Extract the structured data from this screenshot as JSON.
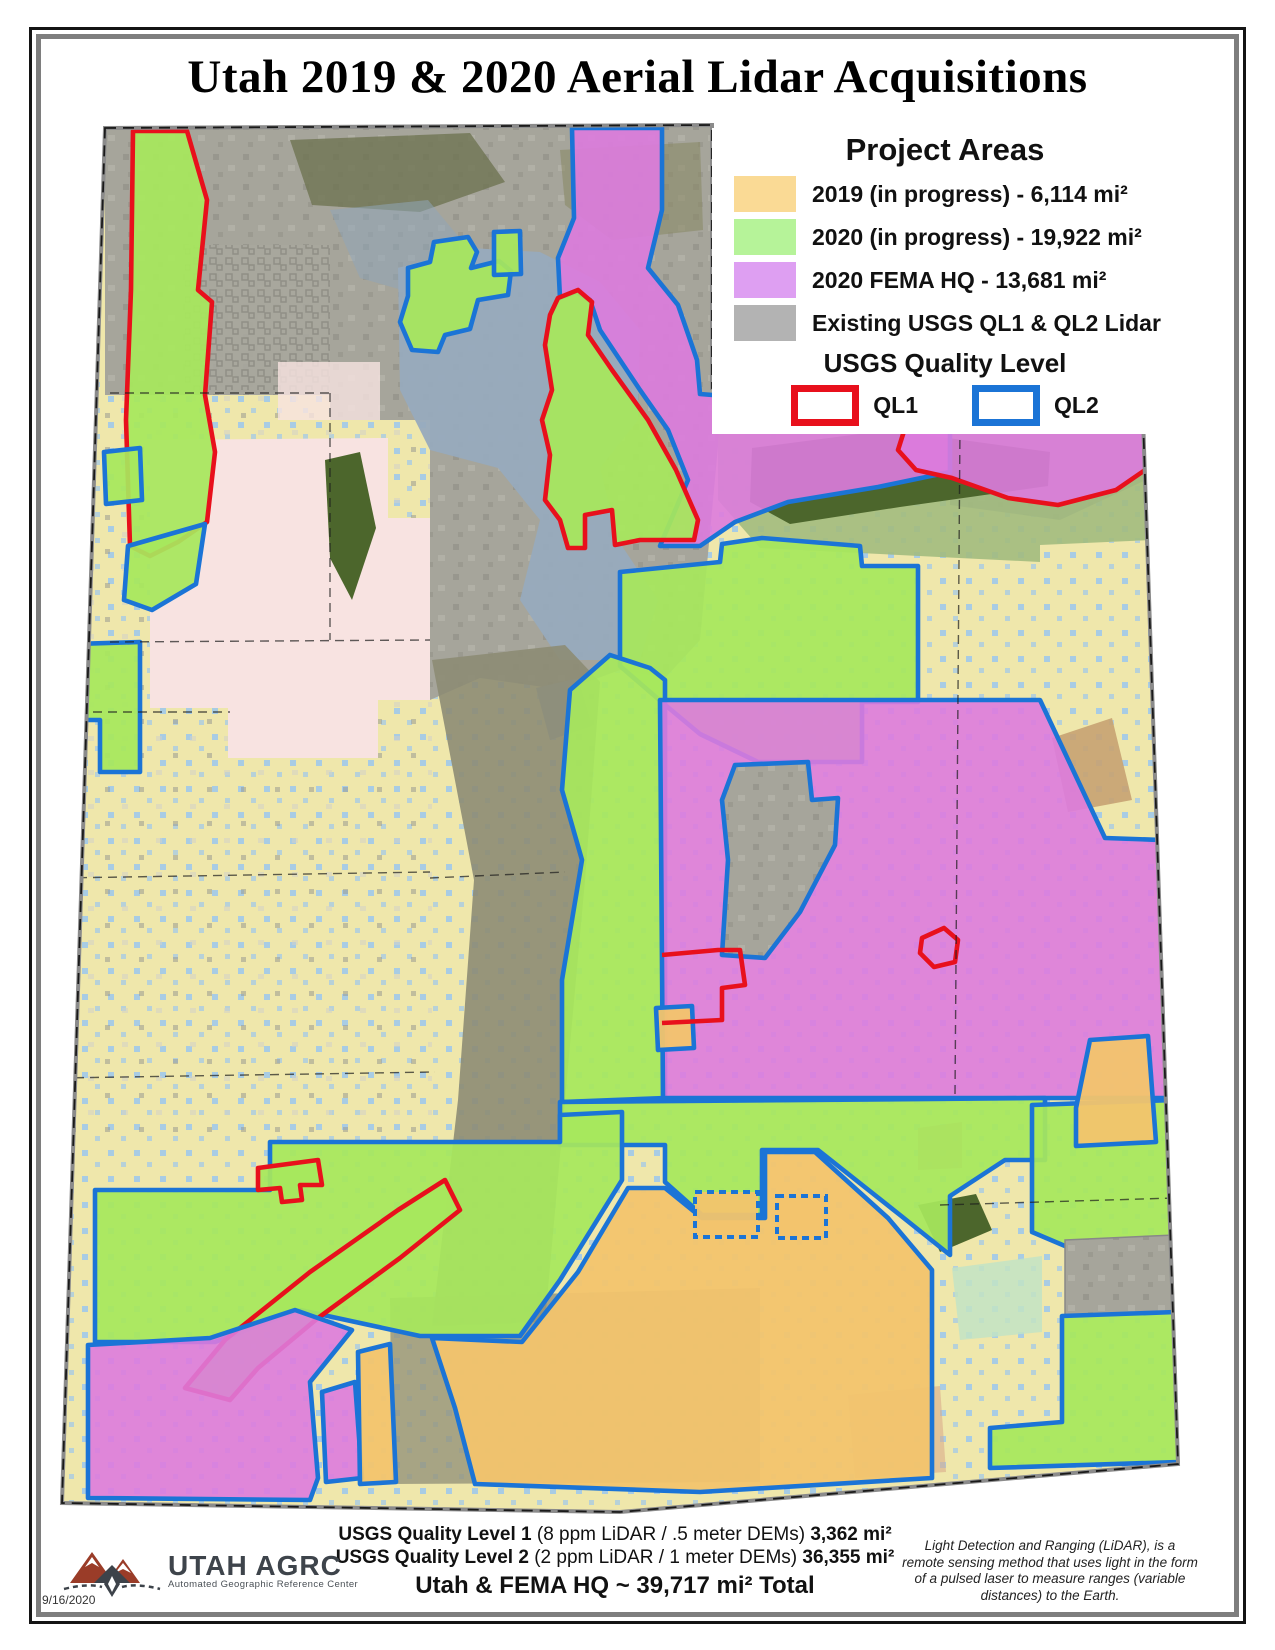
{
  "page": {
    "title": "Utah 2019 & 2020 Aerial Lidar Acquisitions",
    "date": "9/16/2020"
  },
  "legend": {
    "title": "Project Areas",
    "items": [
      {
        "name": "2019-in-progress",
        "label": "2019 (in progress) - 6,114 mi²",
        "color": "#FADA95"
      },
      {
        "name": "2020-in-progress",
        "label": "2020 (in progress) - 19,922 mi²",
        "color": "#B6F399"
      },
      {
        "name": "2020-fema-hq",
        "label": "2020 FEMA HQ - 13,681 mi²",
        "color": "#DE9FF2"
      },
      {
        "name": "existing-usgs-lidar",
        "label": "Existing USGS QL1 & QL2 Lidar",
        "color": "#B3B3B3"
      }
    ],
    "quality": {
      "title": "USGS Quality Level",
      "ql1_label": "QL1",
      "ql2_label": "QL2"
    }
  },
  "footer": {
    "line1": {
      "bold": "USGS Quality Level 1",
      "normal": " (8 ppm LiDAR / .5 meter DEMs) ",
      "value": "3,362 mi²"
    },
    "line2": {
      "bold": "USGS Quality Level 2",
      "normal": " (2 ppm LiDAR / 1 meter DEMs) ",
      "value": "36,355 mi²"
    },
    "total": "Utah & FEMA HQ ~ 39,717 mi²  Total",
    "note": "Light Detection and Ranging (LiDAR), is a remote sensing method that uses light in the form of a pulsed laser to measure ranges (variable distances) to the Earth."
  },
  "logo": {
    "name": "UTAH AGRC",
    "subtitle": "Automated Geographic Reference Center"
  },
  "map": {
    "colors": {
      "base_khaki": "#EFE7AB",
      "speckle_blue": "#9CC7EE",
      "existing_gray": "#A6A59B",
      "green_2020": "#A7E75C",
      "orange_2019": "#F2C46D",
      "fema_magenta": "#DD7BDE",
      "ql1_red": "#E8101C",
      "ql2_blue": "#1B74D6",
      "lake_blue": "#97AABD",
      "pine_green": "#4C662C",
      "pale_pink": "#F8E3E1"
    }
  }
}
